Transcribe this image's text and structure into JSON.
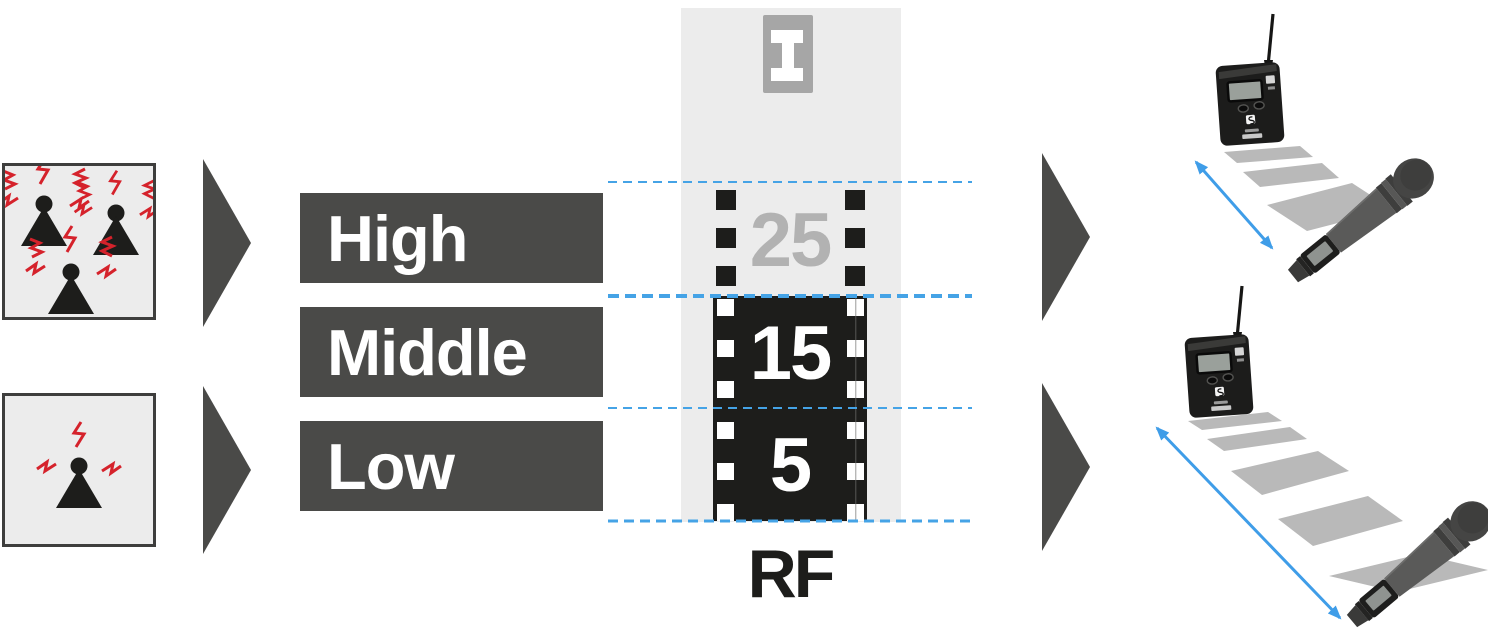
{
  "levels": {
    "high": {
      "label": "High",
      "value": "25"
    },
    "middle": {
      "label": "Middle",
      "value": "15"
    },
    "low": {
      "label": "Low",
      "value": "5"
    }
  },
  "meter": {
    "axis_label": "RF",
    "top_icon_glyph": "I"
  },
  "colors": {
    "interference_red": "#d5222b",
    "range_blue": "#3f9de8",
    "dark_gray": "#4a4a48",
    "film_black": "#1d1d1b",
    "panel_gray": "#ececec",
    "inactive_value_gray": "#b2b2b2",
    "badge_gray": "#a6a6a6",
    "tile_gray": "#b9b9b9"
  },
  "icons": {
    "left_top": "antenna-interference-high-icon",
    "left_bottom": "antenna-interference-low-icon",
    "flow": "flow-arrow-icon",
    "meter_top": "i-beam-icon",
    "right_top": "bodypack-handheld-short-range",
    "right_bottom": "bodypack-handheld-long-range"
  }
}
